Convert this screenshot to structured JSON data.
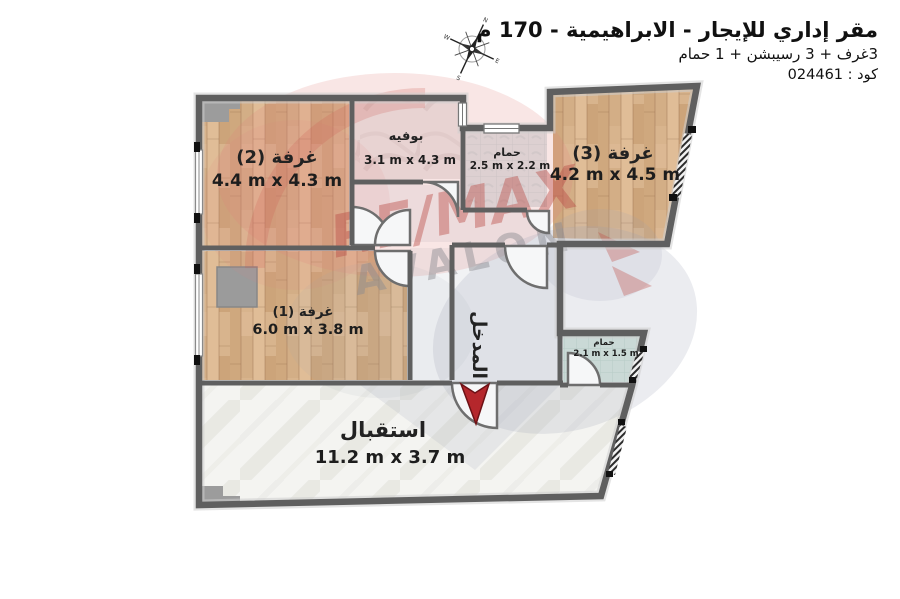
{
  "header": {
    "title": "مقر إداري للإيجار - الابراهيمية - 170 م",
    "subtitle": "3غرف + 3 رسيبشن + 1 حمام",
    "code": "كود : 024461"
  },
  "rooms": {
    "room2": {
      "name": "غرفة (2)",
      "dims": "4.4 m x 4.3 m"
    },
    "buffet": {
      "name": "بوفيه",
      "dims": "3.1 m x 4.3 m"
    },
    "bath_top": {
      "name": "حمام",
      "dims": "2.5 m x 2.2 m"
    },
    "room3": {
      "name": "غرفة (3)",
      "dims": "4.2 m x 4.5 m"
    },
    "room1": {
      "name": "غرفة (1)",
      "dims": "6.0 m x 3.8 m"
    },
    "bath_small": {
      "name": "حمام",
      "dims": "2.1 m x 1.5 m"
    },
    "reception": {
      "name": "استقبال",
      "dims": "11.2 m x 3.7 m"
    },
    "entrance": {
      "label": "المدخل"
    }
  },
  "watermark": {
    "brand": "RE/MAX",
    "sub": "AVALON"
  },
  "colors": {
    "wall": "#5f5f5f",
    "wood": "#d8b48d",
    "tile_gray": "#eae8e8",
    "tile_blue": "#dce4e6",
    "tile_green": "#d6e8df",
    "marble": "#f4f4f1",
    "arrow_red": "#b5272c",
    "watermark_red": "#b94a44",
    "watermark_gray": "#8a8a90"
  }
}
